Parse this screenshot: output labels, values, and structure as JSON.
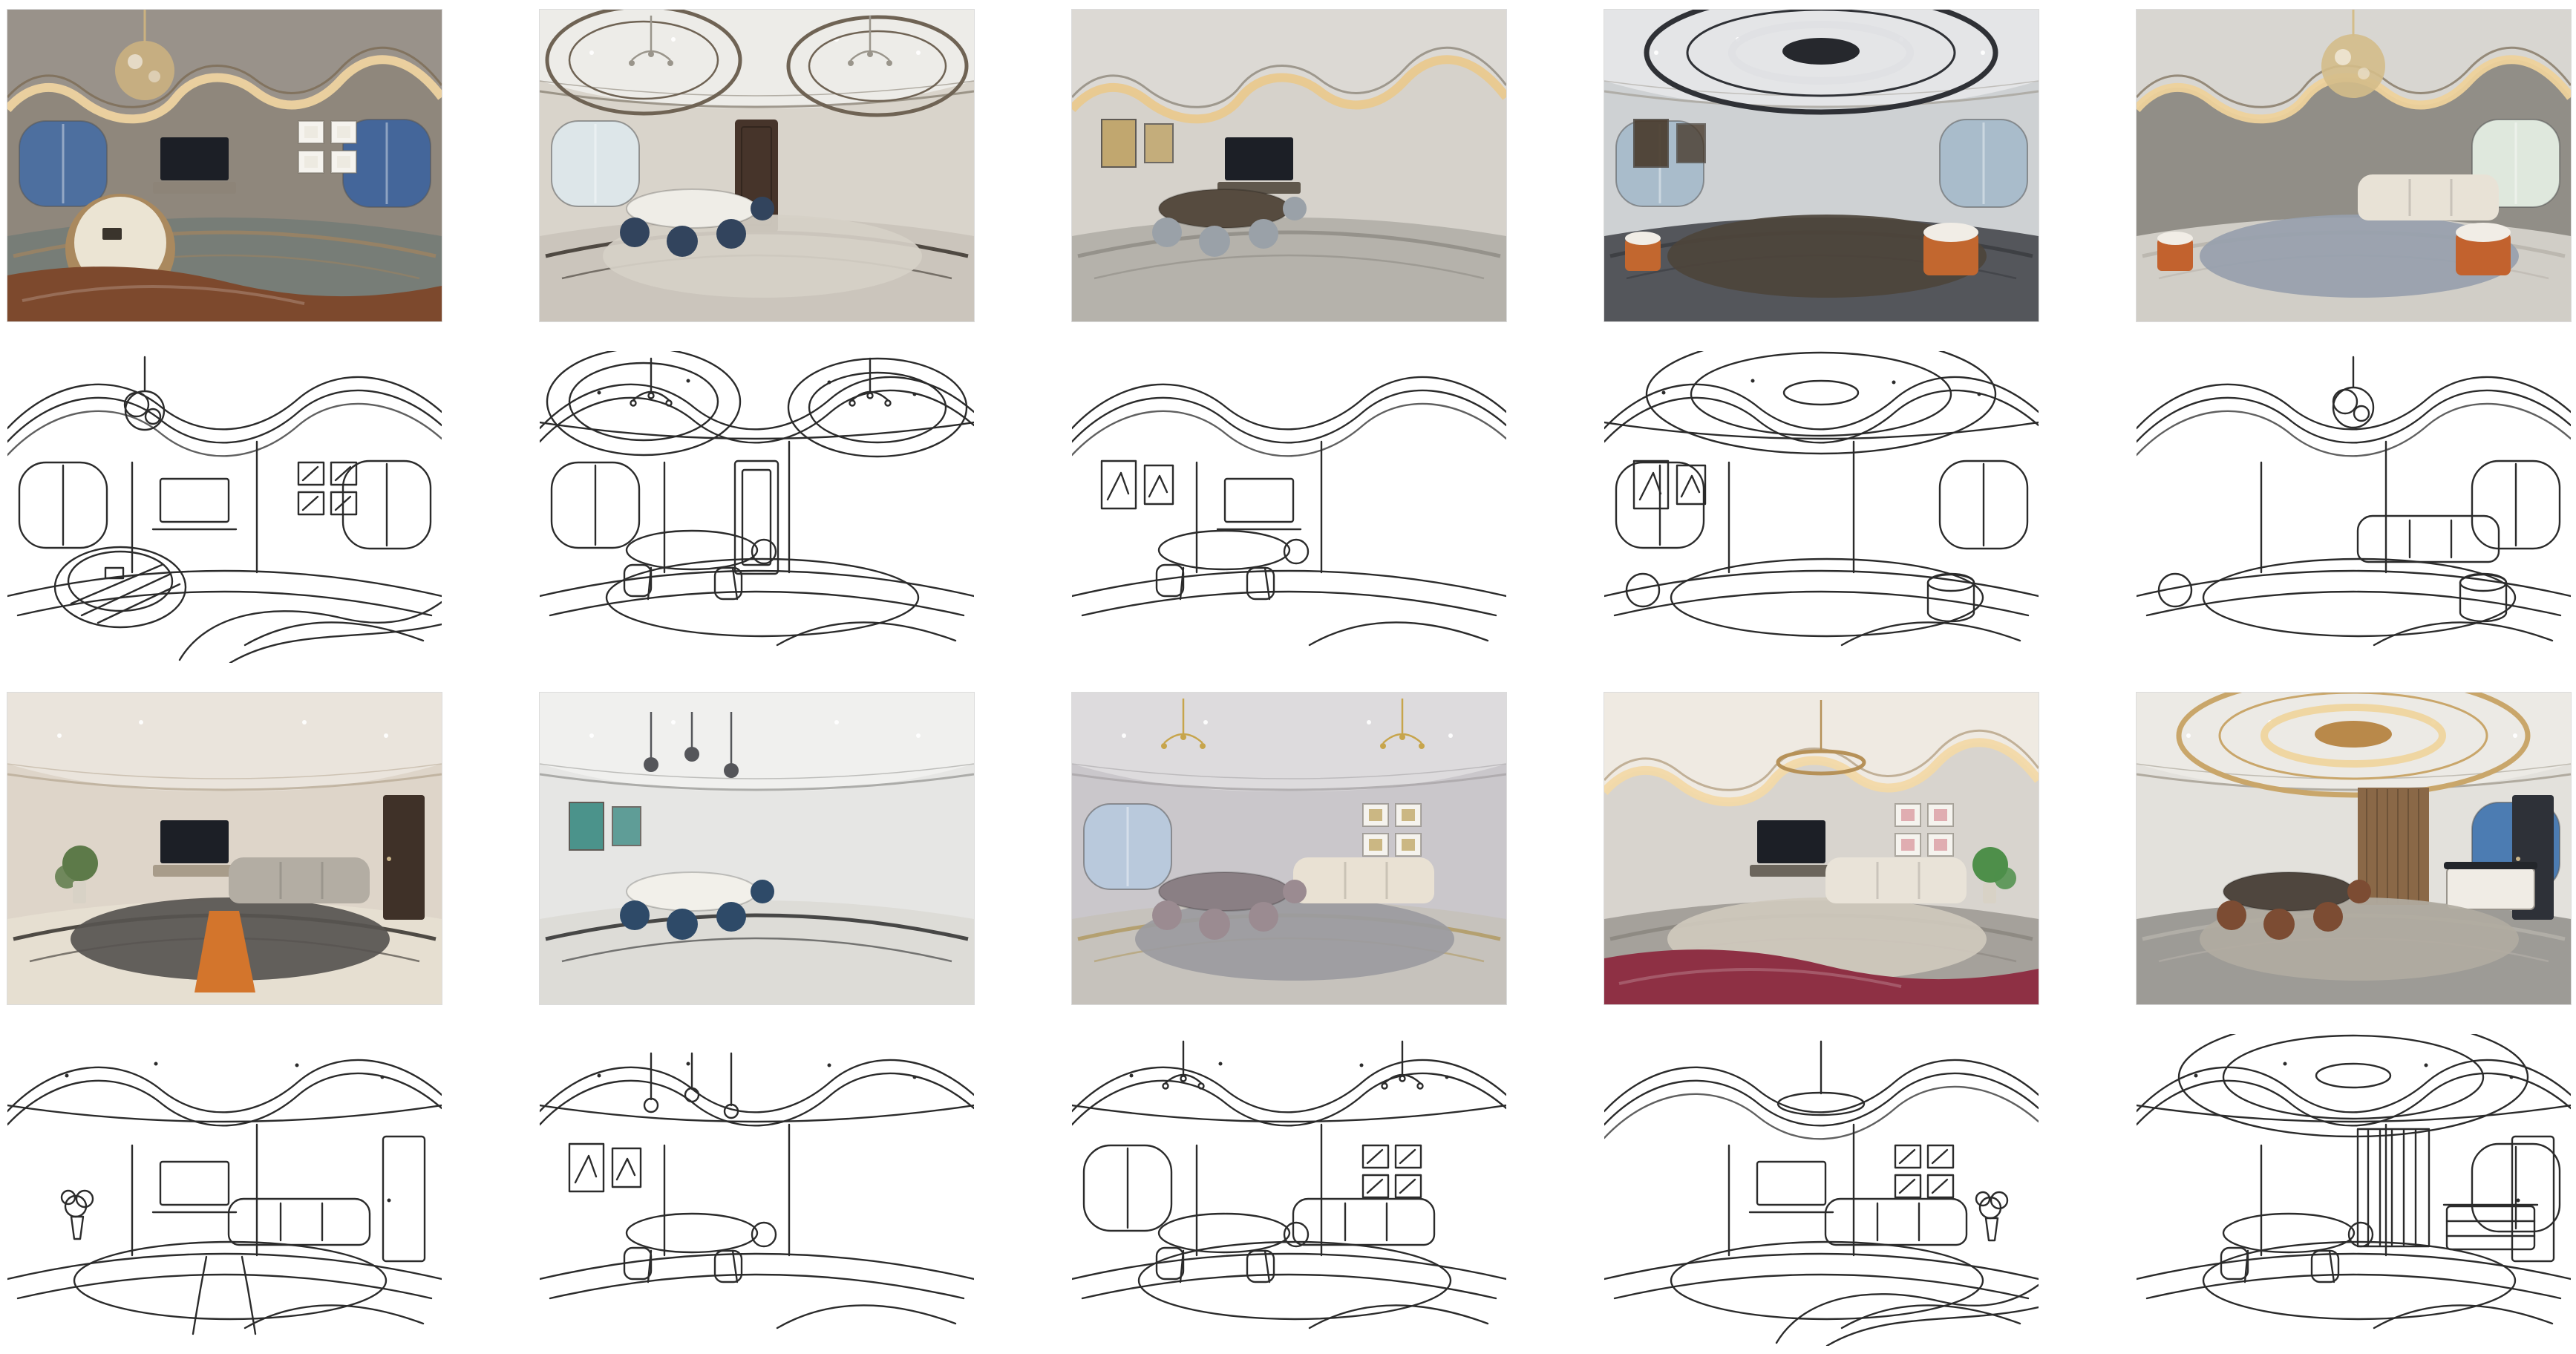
{
  "figure": {
    "kind": "panorama-sketch-pair-grid",
    "columns": 5,
    "pair_rows": 2,
    "row_order": [
      "photo",
      "sketch"
    ],
    "background": "#ffffff",
    "sketch_line_color": "#2b2b2b"
  },
  "pairs": [
    {
      "id": "r1c1",
      "photo": {
        "alt": "Evening living room panorama with crystal chandelier, gold cove-lit wavy ceiling, dusk-blue windows, TV wall, square picture frames and a round cream coffee table over a brown rug",
        "palette": {
          "wall": "#8f877c",
          "ceiling": "#99928a",
          "trim": "#7c6b54",
          "glow": "#eed3a0",
          "floor": "#777d77",
          "inlay": "#9b8263",
          "window": "#4d6f9f",
          "windowR": "#44669a",
          "frame": "#e9e5db",
          "tableTop": "#ebe4d3",
          "tableEdge": "#aa895e",
          "fg": "#7d492d",
          "chand": "#cbb180",
          "tvstand": "#8d8478"
        }
      },
      "sketch": {
        "alt": "Line-drawing sketch of the evening living room panorama with round table and curved ceiling lines"
      },
      "features": [
        "cove",
        "chandBallLeft",
        "windowLeft",
        "windowRight",
        "tv",
        "framesRight",
        "roundTable",
        "fgBand"
      ]
    },
    {
      "id": "r1c2",
      "photo": {
        "alt": "Bright dining and living panorama with double elliptical ceiling trims, chandelier, navy velvet chairs around a round table, dark wood entry door and curved dark floor inlays",
        "palette": {
          "wall": "#d9d4cb",
          "ceiling": "#edece8",
          "trim": "#8b8376",
          "ring": "#6f6354",
          "window": "#dde6e9",
          "door": "#46342a",
          "table": "#efede7",
          "chair": "#32445d",
          "floor": "#cbc5bc",
          "inlay": "#3a332d",
          "rug": "#d6d0c7",
          "chand": "#9a958b"
        }
      },
      "sketch": {
        "alt": "Line-drawing sketch of the dining room panorama with oval ceiling rings and entry door"
      },
      "features": [
        "smooth",
        "ovalPair",
        "chandPair",
        "windowLeft",
        "door",
        "dining",
        "rug"
      ]
    },
    {
      "id": "r1c3",
      "photo": {
        "alt": "Dining area panorama with tall white column, grey marble floor, grey upholstered chairs, dark wood TV wall and a warm cove-lit ceiling arc",
        "palette": {
          "wall": "#d6d2cb",
          "ceiling": "#dcd9d4",
          "glow": "#e9c98e",
          "trim": "#8f877a",
          "floor": "#b5b2ab",
          "inlay": "#8f8c85",
          "chair": "#9aa1a8",
          "table": "#564b3f",
          "frame": "#c0a468",
          "tvstand": "#5f574c"
        }
      },
      "sketch": {
        "alt": "Line-drawing sketch of the dining area panorama with column, table and chairs"
      },
      "features": [
        "cove",
        "dining",
        "tv",
        "framesLeft"
      ]
    },
    {
      "id": "r1c4",
      "photo": {
        "alt": "Office lounge panorama with dark oval ceiling ring and central disc, city-view windows, dark display shelving, dark grey carpet, wood platform and orange drum stools",
        "palette": {
          "wall": "#ced1d3",
          "ceiling": "#e4e5e7",
          "ring": "#2f3136",
          "disc": "#26282d",
          "glow": "#dfe0e3",
          "window": "#a9bccb",
          "windowR": "#a9bccb",
          "floor": "#54565b",
          "inlay": "#3b3c41",
          "accent": "#c2672f",
          "frame": "#4a3c2e",
          "rug": "#4d443b"
        }
      },
      "sketch": {
        "alt": "Line-drawing sketch of the office lounge panorama with oval ceiling, shelf grid and drum stool"
      },
      "features": [
        "smooth",
        "ovalCenter",
        "windowLeft",
        "windowRight",
        "ottomans",
        "framesLeft",
        "rug"
      ]
    },
    {
      "id": "r1c5",
      "photo": {
        "alt": "Grey living room panorama with crystal ball chandelier, wavy gold cove lighting, white sofa, orange and teal armchairs on a blue-grey rug and bright plant-filled window",
        "palette": {
          "wall": "#918e87",
          "ceiling": "#d8d6d1",
          "trim": "#857763",
          "glow": "#eed29b",
          "floor": "#d1cec7",
          "inlay": "#b9b4ab",
          "rug": "#97a0ac",
          "sofa": "#e8e2d6",
          "accent": "#c2622e",
          "windowR": "#dfe8dd",
          "chand": "#d4bd8a"
        }
      },
      "sketch": {
        "alt": "Line-drawing sketch of the grey living room panorama with chandelier scribble and seating"
      },
      "features": [
        "cove",
        "chandBallCenter",
        "sofa",
        "rug",
        "windowRight",
        "ottomans"
      ]
    },
    {
      "id": "r2c1",
      "photo": {
        "alt": "Cream living room panorama seen from a hallway with arched walls, recessed spotlights, grey sofa, dark rug with orange runner, plant, dark door and cream marble floor with black inlay",
        "palette": {
          "wall": "#ded5c9",
          "ceiling": "#eae4dc",
          "trim": "#b9ab97",
          "floor": "#e6dfd1",
          "inlay": "#33302b",
          "rug": "#575450",
          "accent": "#d3752c",
          "sofa": "#b3ada3",
          "door": "#3f3128",
          "plant": "#5d7a49",
          "tvstand": "#a89c8a"
        }
      },
      "sketch": {
        "alt": "Line-drawing sketch of the cream living room panorama with rug runner and doorway"
      },
      "features": [
        "smooth",
        "sofa",
        "rug",
        "runner",
        "plantLeft",
        "doorRight",
        "tv"
      ]
    },
    {
      "id": "r2c2",
      "photo": {
        "alt": "White dining room panorama with long oval white table, navy blue velvet chairs, pair of teal artworks, pendant lamps, white paneled partition and curved dark floor kerb",
        "palette": {
          "wall": "#e6e6e4",
          "ceiling": "#f0f0ee",
          "trim": "#9c9c99",
          "floor": "#dddcd7",
          "inlay": "#2d2d2d",
          "chair": "#2e4a68",
          "table": "#f2f0ea",
          "frame": "#3e8c84",
          "chand": "#55565a"
        }
      },
      "sketch": {
        "alt": "Line-drawing sketch of the white dining room panorama with table, chairs and partition"
      },
      "features": [
        "smooth",
        "pendants",
        "framesLeft",
        "dining"
      ]
    },
    {
      "id": "r2c3",
      "photo": {
        "alt": "Lavender-grey living and dining panorama with two gold chandeliers, cream sofa with blue pillows, gallery wall of frames, mauve dining chairs, blue curtains and grey rug with gold border",
        "palette": {
          "wall": "#cac7cb",
          "ceiling": "#dddbdd",
          "trim": "#a9a5a8",
          "window": "#b9c9dc",
          "floor": "#c6c2bc",
          "inlay": "#b09a63",
          "sofa": "#e9e1d3",
          "chair": "#9b8b91",
          "table": "#8a7f84",
          "rug": "#9b9ba0",
          "frame": "#b99c56",
          "chand": "#c7a54c"
        }
      },
      "sketch": {
        "alt": "Line-drawing sketch of the lavender living and dining panorama with chandeliers and gallery wall"
      },
      "features": [
        "smooth",
        "chandPair",
        "windowLeft",
        "framesRight",
        "sofa",
        "rug",
        "dining"
      ]
    },
    {
      "id": "r2c4",
      "photo": {
        "alt": "Soft pink and cream suite panorama with ring chandelier, warm cove-lit ceiling, TV wall, pink artworks, green aquarium niche and burgundy bedspread in the foreground",
        "palette": {
          "wall": "#d8d4ce",
          "ceiling": "#efeae2",
          "trim": "#b5a184",
          "glow": "#f2d9a8",
          "chand": "#b69158",
          "sofa": "#e9e3d8",
          "frame": "#d78f97",
          "plant": "#4e8f4a",
          "fg": "#8e3044",
          "floor": "#a5a19b",
          "inlay": "#8a867f",
          "rug": "#cfc9bd"
        }
      },
      "sketch": {
        "alt": "Line-drawing sketch of the suite panorama with ring light and draped bed foreground"
      },
      "features": [
        "cove",
        "ringChand",
        "sofa",
        "tv",
        "framesRight",
        "plantRight",
        "rug",
        "fgBand"
      ]
    },
    {
      "id": "r2c5",
      "photo": {
        "alt": "Dining room panorama with large oval cove-lit ceiling ring, wood slat feature wall, brown leather chairs, white sideboard with black top, blue aquarium window and glass door",
        "palette": {
          "wall": "#e3e1dc",
          "ceiling": "#eceae5",
          "trim": "#a39c90",
          "ring": "#c9a66a",
          "disc": "#b9894a",
          "glow": "#f0d49a",
          "wood": "#8a6847",
          "chair": "#7c4c33",
          "table": "#4f463e",
          "window": "#4c7cb2",
          "windowR": "#4c7cb2",
          "door": "#2e3138",
          "floor": "#9d9b96",
          "inlay": "#b5b1aa",
          "rug": "#b1aba1"
        }
      },
      "sketch": {
        "alt": "Line-drawing sketch of the dining room panorama with oval ceiling ring, sideboard and glass door"
      },
      "features": [
        "smooth",
        "ovalCenter",
        "woodWall",
        "dining",
        "sideboard",
        "windowRight",
        "doorRight",
        "rug"
      ]
    }
  ]
}
